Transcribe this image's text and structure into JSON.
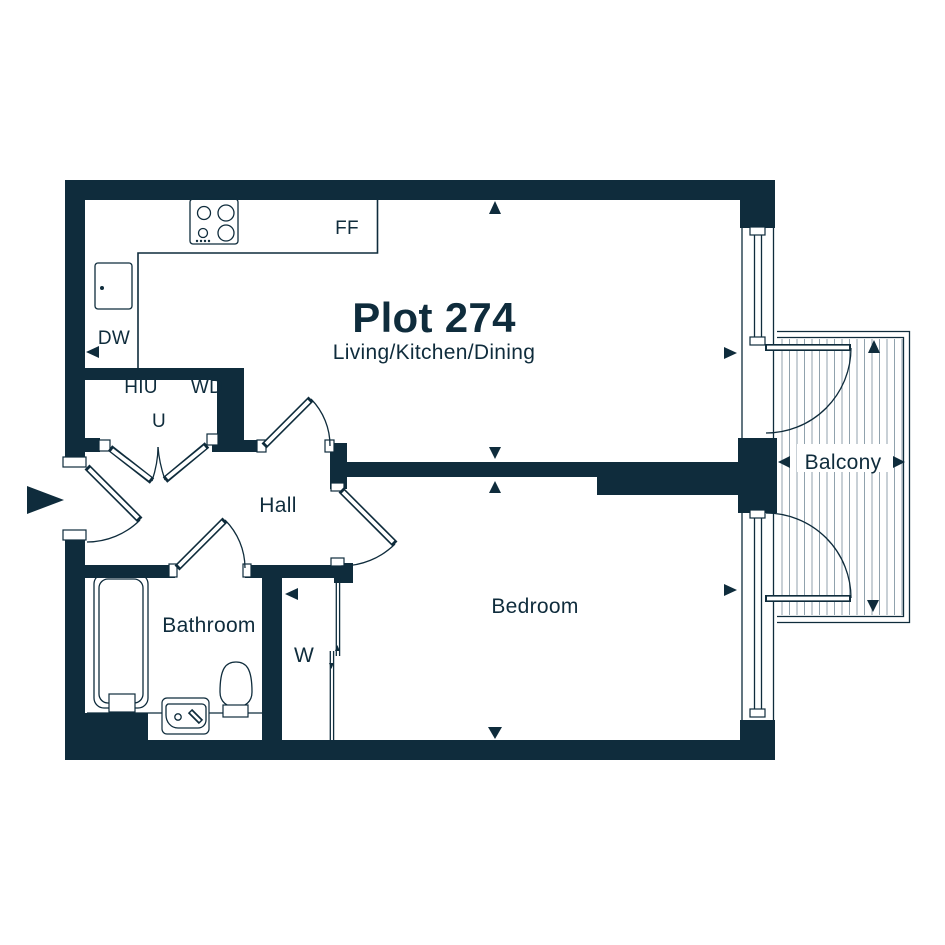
{
  "title": "Plot 274",
  "subtitle": "Living/Kitchen/Dining",
  "rooms": {
    "hall": "Hall",
    "bathroom": "Bathroom",
    "bedroom": "Bedroom",
    "balcony": "Balcony"
  },
  "fixtures": {
    "fridge_freezer": "FF",
    "dishwasher": "DW",
    "heat_interface_unit": "HIU",
    "washer_dryer": "WD",
    "utility": "U",
    "wardrobe": "W"
  },
  "colors": {
    "wall": "#0f2c3c",
    "text": "#0f2c3c",
    "hatch": "#90a2ad",
    "background": "#ffffff"
  }
}
